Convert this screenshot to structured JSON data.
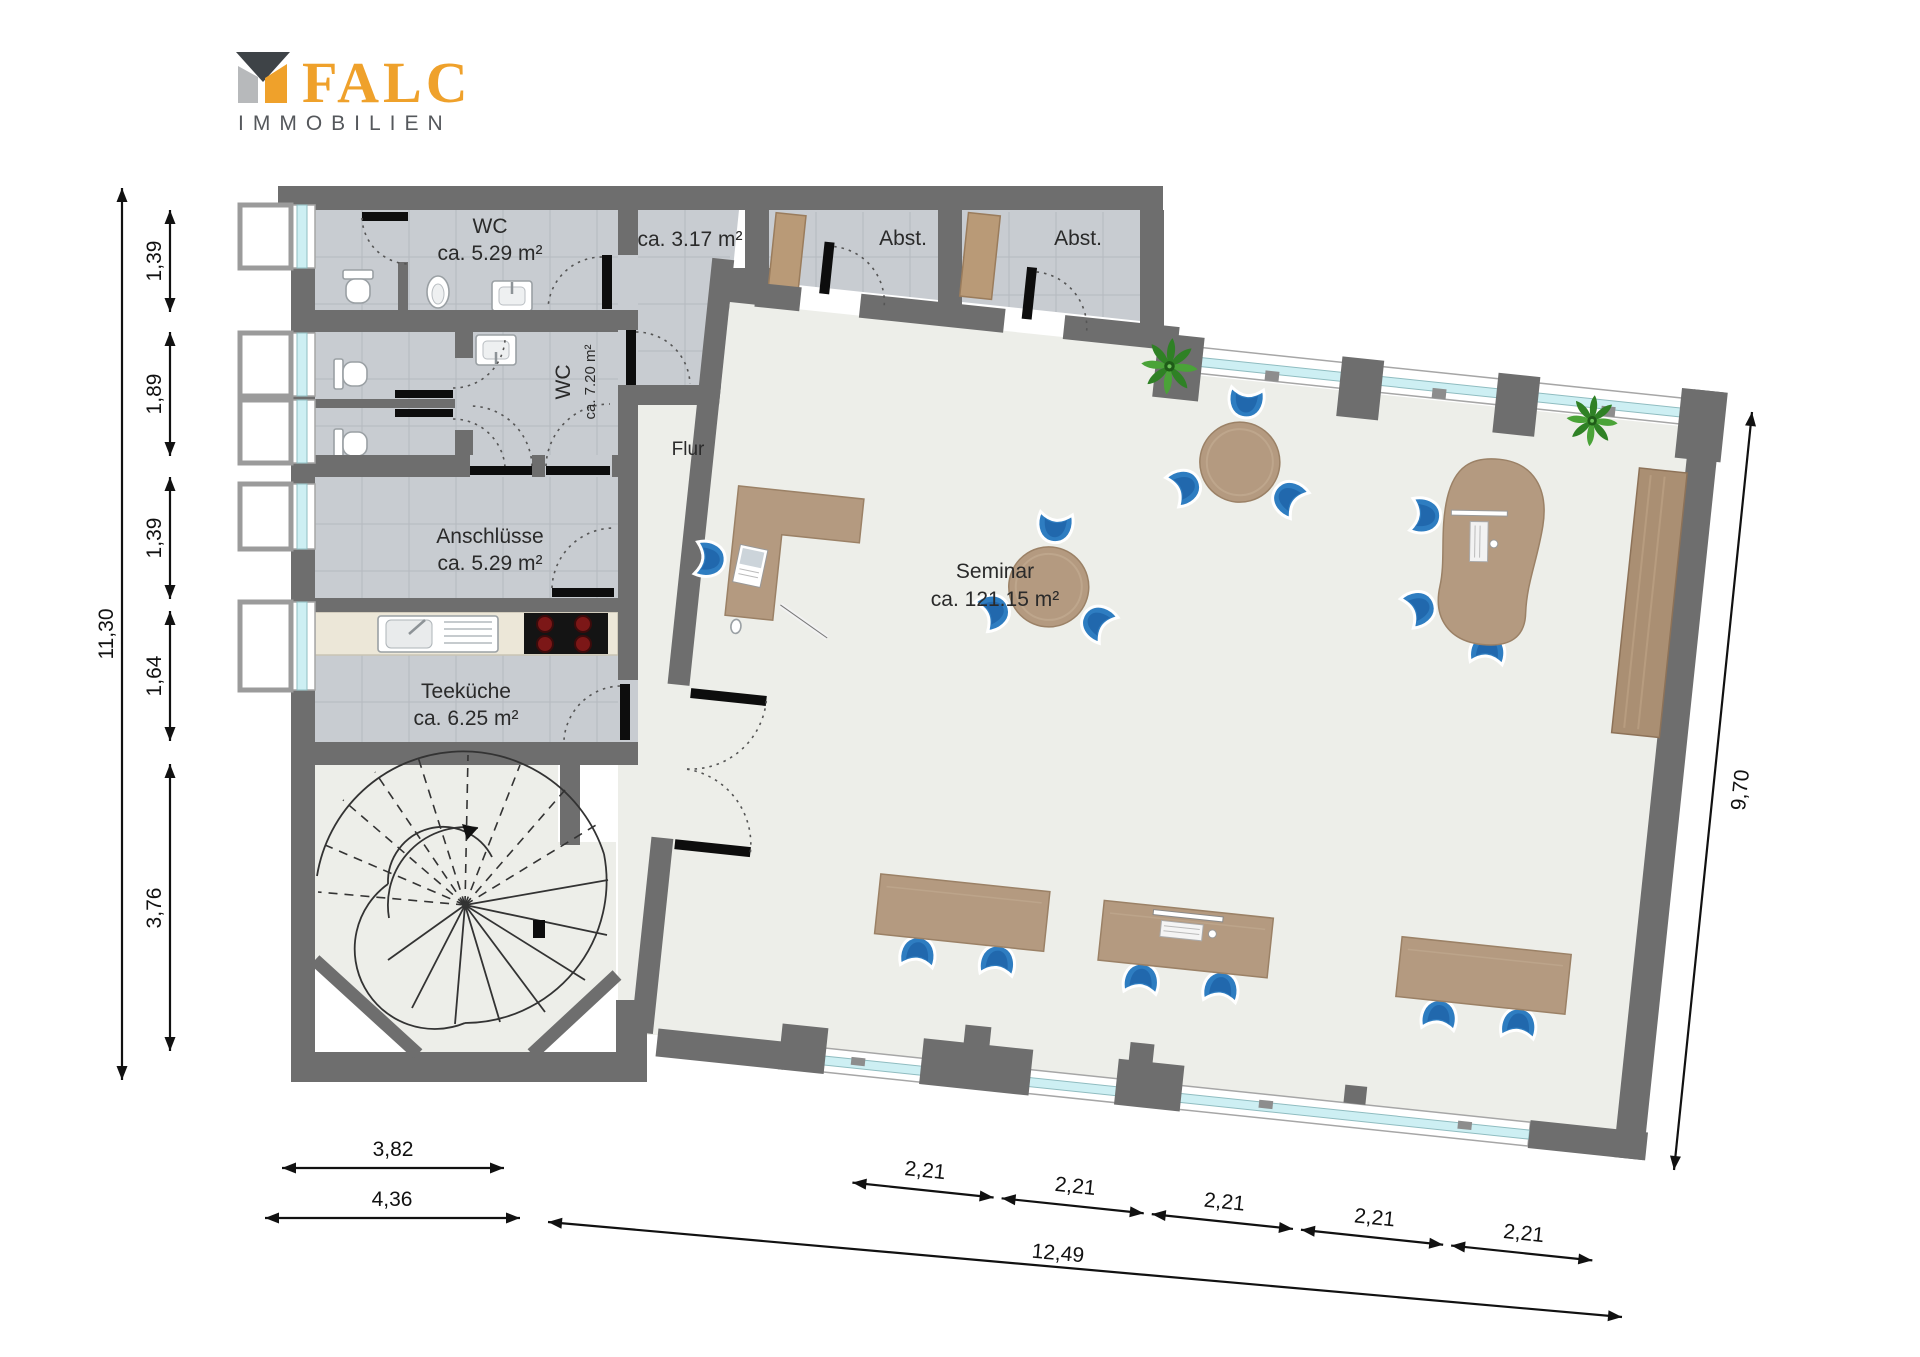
{
  "logo": {
    "brand": "FALC",
    "subtitle": "IMMOBILIEN"
  },
  "rooms": {
    "wc1": {
      "name": "WC",
      "area": "ca. 5.29 m²"
    },
    "wc2": {
      "name": "WC",
      "area": "ca. 7.20 m²"
    },
    "storage_small": {
      "area": "ca. 3.17 m²"
    },
    "abst1": {
      "name": "Abst."
    },
    "abst2": {
      "name": "Abst."
    },
    "anschluesse": {
      "name": "Anschlüsse",
      "area": "ca. 5.29 m²"
    },
    "teekueche": {
      "name": "Teeküche",
      "area": "ca. 6.25 m²"
    },
    "flur": {
      "name": "Flur"
    },
    "seminar": {
      "name": "Seminar",
      "area": "ca. 121.15 m²"
    }
  },
  "dimensions": {
    "left_total": "11,30",
    "left_segments": [
      "1,39",
      "1,89",
      "1,39",
      "1,64",
      "3,76"
    ],
    "right_total": "9,70",
    "bottom_left_inner": "3,82",
    "bottom_left_outer": "4,36",
    "bottom_segments": [
      "2,21",
      "2,21",
      "2,21",
      "2,21",
      "2,21"
    ],
    "bottom_total": "12,49"
  },
  "colors": {
    "brand_orange": "#EFA12B",
    "wall_gray": "#6e6e6e",
    "tile_floor": "#c8ccd1",
    "room_floor": "#edeee9",
    "window_glass": "#cdeff3",
    "chair_blue": "#2e7dc1",
    "wood": "#b49a80"
  }
}
